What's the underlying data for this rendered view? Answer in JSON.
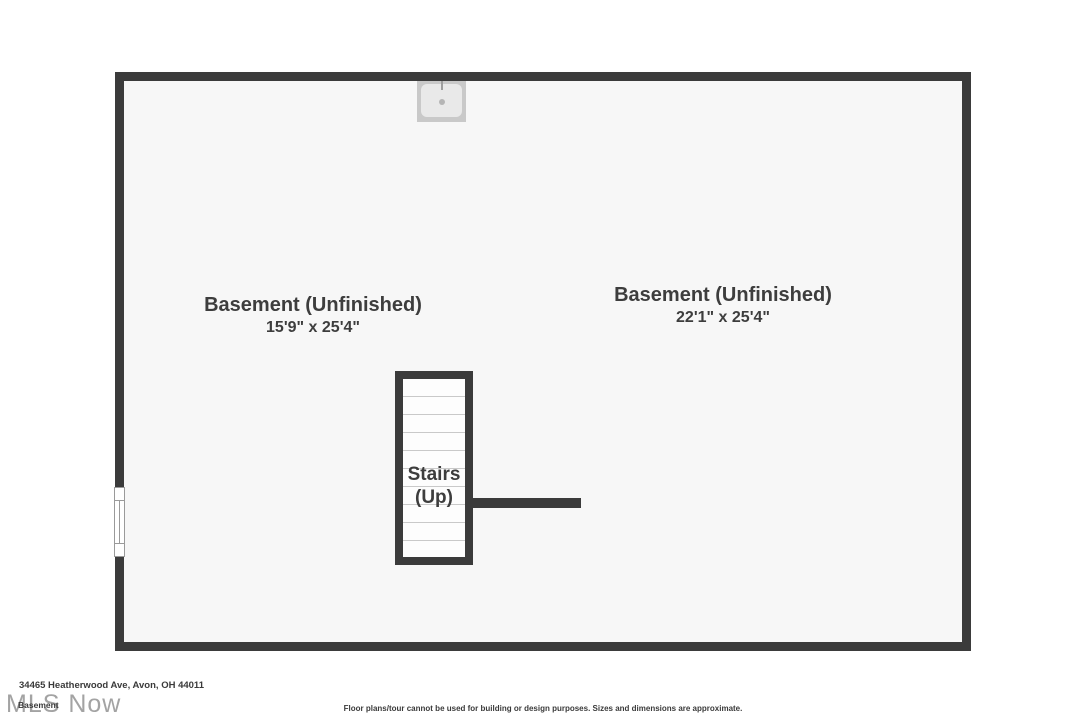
{
  "plan": {
    "rooms": [
      {
        "name": "Basement (Unfinished)",
        "dims": "15'9\" x 25'4\""
      },
      {
        "name": "Basement (Unfinished)",
        "dims": "22'1\" x 25'4\""
      }
    ],
    "stairs": {
      "line1": "Stairs",
      "line2": "(Up)"
    },
    "fixtures": [
      {
        "icon": "sink-icon"
      }
    ],
    "features": [
      {
        "icon": "window-icon",
        "wall": "left"
      }
    ]
  },
  "footer": {
    "address": "34465 Heatherwood Ave, Avon, OH 44011",
    "floor_label": "Basement",
    "watermark": "MLS Now",
    "disclaimer": "Floor plans/tour cannot be used for building or design purposes. Sizes and dimensions are approximate."
  },
  "colors": {
    "wall": "#3b3b3b",
    "interior_fill": "#f7f7f7",
    "page_background": "#ffffff",
    "label_text": "#3d3d3d",
    "step_line": "#c9c9c9",
    "sink_outer": "#c9c9c9",
    "sink_basin": "#e9e9e9",
    "window_frame": "#9a9a9a",
    "watermark_text": "#a3a3a3"
  }
}
